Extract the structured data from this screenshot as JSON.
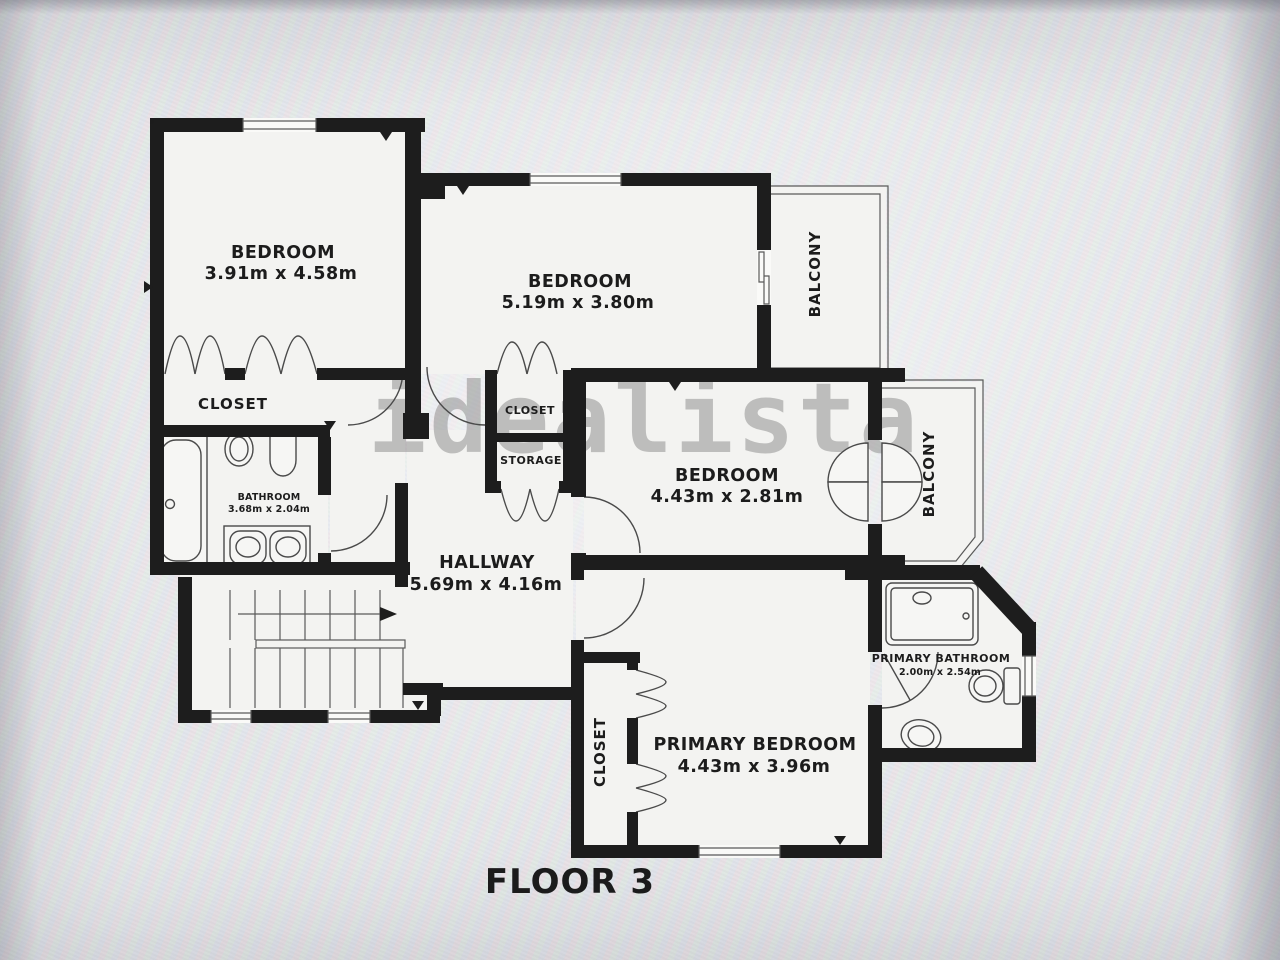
{
  "floor_plan": {
    "floor_label": "FLOOR 3",
    "watermark": "idealista",
    "rooms": {
      "bedroom1": {
        "label": "BEDROOM",
        "dims": "3.91m x 4.58m"
      },
      "bedroom2": {
        "label": "BEDROOM",
        "dims": "5.19m x 3.80m"
      },
      "bedroom3": {
        "label": "BEDROOM",
        "dims": "4.43m x 2.81m"
      },
      "primary_bedroom": {
        "label": "PRIMARY BEDROOM",
        "dims": "4.43m x 3.96m"
      },
      "hallway": {
        "label": "HALLWAY",
        "dims": "5.69m x 4.16m"
      },
      "bathroom": {
        "label": "BATHROOM",
        "dims": "3.68m x 2.04m"
      },
      "primary_bathroom": {
        "label": "PRIMARY BATHROOM",
        "dims": "2.00m x 2.54m"
      },
      "closet_bedroom1": {
        "label": "CLOSET"
      },
      "closet_hall": {
        "label": "CLOSET"
      },
      "storage": {
        "label": "STORAGE"
      },
      "closet_primary": {
        "label": "CLOSET"
      },
      "balcony_top": {
        "label": "BALCONY"
      },
      "balcony_right": {
        "label": "BALCONY"
      }
    },
    "colors": {
      "wall": "#1d1d1d",
      "room_fill": "#f3f3f1",
      "background": "#e8e8ea",
      "watermark_gray": "#6e6e6e",
      "text": "#1c1c1c"
    }
  }
}
